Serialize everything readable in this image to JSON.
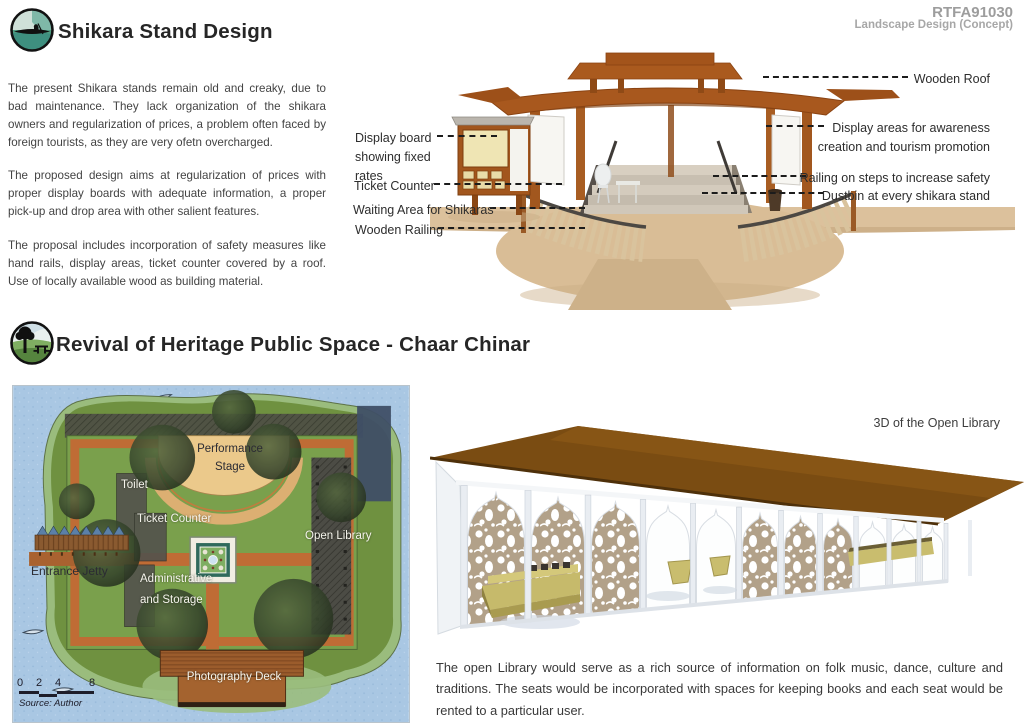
{
  "header": {
    "project_code": "RTFA91030",
    "project_type": "Landscape Design (Concept)"
  },
  "section_shikara": {
    "title": "Shikara Stand Design",
    "paragraphs": [
      "The present Shikara stands remain old and creaky, due to bad maintenance. They lack organization of the shikara owners and regularization of prices, a problem often faced by foreign tourists, as they are very ofetn overcharged.",
      "The proposed design aims at regularization of prices with proper display boards with adequate information, a proper pick-up and drop area with other salient features.",
      "The proposal includes incorporation of safety measures like hand rails, display areas, ticket counter covered by a roof. Use of locally available wood as building material."
    ],
    "callouts": {
      "display_board": "Display board showing fixed rates",
      "ticket_counter": "Ticket Counter",
      "waiting_area": "Waiting Area for Shikaras",
      "wooden_railing": "Wooden Railing",
      "wooden_roof": "Wooden Roof",
      "display_areas": "Display areas for awareness creation and tourism promotion",
      "railing_steps": "Railing on steps to increase safety",
      "dustbin": "Dustbin at every shikara stand"
    }
  },
  "section_chaar_chinar": {
    "title": "Revival of Heritage Public Space - Chaar Chinar",
    "plan_labels": {
      "performance_stage": "Performance Stage",
      "toilet": "Toilet",
      "ticket_counter": "Ticket Counter",
      "open_library": "Open Library",
      "entrance_jetty": "Entrance Jetty",
      "admin_storage": "Administrative and Storage",
      "photography_deck": "Photography Deck",
      "scale_ticks": [
        "0",
        "2",
        "4",
        "8"
      ],
      "source": "Source: Author"
    },
    "render_label": "3D of the Open Library",
    "description": "The open Library would serve as a rich source of information on folk music, dance, culture and traditions. The seats would be incorporated with spaces for keeping books and each seat would be rented to a particular user."
  },
  "colors": {
    "wood_brown": "#a8581e",
    "roof_dark_brown": "#7a4c12",
    "water_blue": "#a9c7e3",
    "lawn_green": "#7aa04c",
    "path_orange": "#bf6c35",
    "seat_khaki": "#c6ba6b",
    "header_gray": "#9d9d9d"
  }
}
